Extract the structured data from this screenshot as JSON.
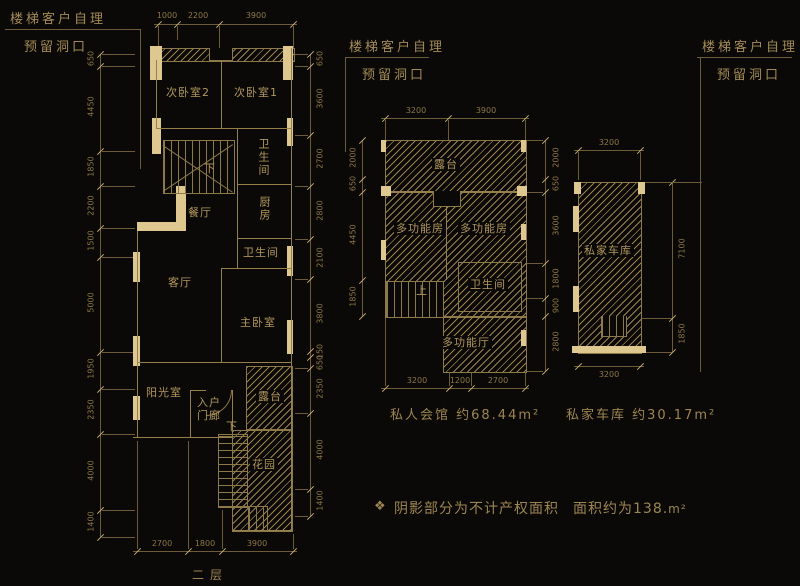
{
  "annotations": {
    "left": {
      "line1": "楼梯客户自理",
      "line2": "预留洞口"
    },
    "middle": {
      "line1": "楼梯客户自理",
      "line2": "预留洞口"
    },
    "right": {
      "line1": "楼梯客户自理",
      "line2": "预留洞口"
    }
  },
  "floor2": {
    "caption": "二层",
    "rooms": {
      "bedroom2": "次卧室2",
      "bedroom1": "次卧室1",
      "bath_upper": "卫生间",
      "kitchen": "厨房",
      "dining": "餐厅",
      "bath_mid": "卫生间",
      "living": "客厅",
      "master": "主卧室",
      "sunroom": "阳光室",
      "porch": "入户门廊",
      "terrace": "露台",
      "garden": "花园"
    },
    "stairs": {
      "upper": "下",
      "lower": "下"
    },
    "dims": {
      "top": [
        "1000",
        "2200",
        "3900"
      ],
      "left": [
        "650",
        "4450",
        "1850",
        "2200",
        "1500",
        "5000",
        "1950",
        "2350",
        "4000",
        "1400"
      ],
      "right": [
        "650",
        "3600",
        "2700",
        "2800",
        "2100",
        "3800",
        "150",
        "650",
        "2350",
        "4000",
        "1400"
      ],
      "bottom": [
        "2700",
        "1800",
        "3900"
      ]
    }
  },
  "club": {
    "caption": "私人会馆 约68.44m²",
    "rooms": {
      "terrace": "露台",
      "multi1": "多功能房",
      "multi2": "多功能房",
      "bath": "卫生间",
      "hall": "多功能厅"
    },
    "stairs": {
      "up": "上"
    },
    "dims": {
      "top": [
        "3200",
        "3900"
      ],
      "left": [
        "2000",
        "650",
        "4450",
        "1850"
      ],
      "right": [
        "2000",
        "650",
        "3600",
        "1800",
        "900",
        "2800"
      ],
      "bottom": [
        "3200",
        "1200",
        "2700"
      ]
    }
  },
  "garage": {
    "caption": "私家车库 约30.17m²",
    "room": "私家车库",
    "dims": {
      "top": [
        "3200"
      ],
      "right": [
        "7100",
        "1850"
      ],
      "bottom": [
        "3200"
      ]
    }
  },
  "note": {
    "marker": "❖",
    "text": "阴影部分为不计产权面积",
    "area": "面积约为138.",
    "unit": "m²"
  },
  "colors": {
    "background": "#0a0907",
    "line": "#6e5c38",
    "wall": "#95804c",
    "pier": "#dfc890",
    "text": "#b2975e",
    "dim_text": "#8e7747"
  }
}
